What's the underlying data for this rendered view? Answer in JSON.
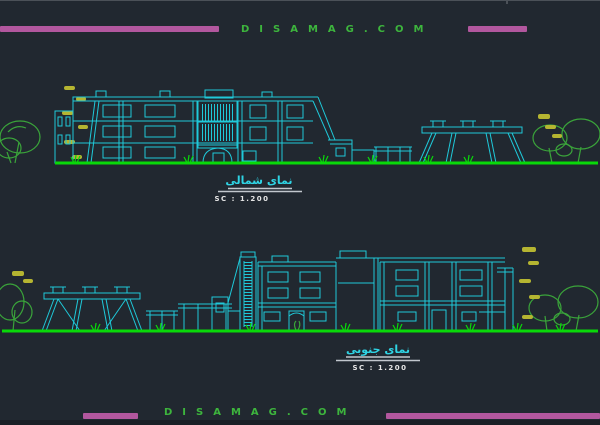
{
  "watermark": {
    "text": "DISAMAG.COM"
  },
  "colors": {
    "background": "#212830",
    "line_cyan": "#1fc9d9",
    "ground_green": "#09d909",
    "tree_green": "#3aa43a",
    "accent_yellow": "#b5b531",
    "bar_magenta": "#b2579e",
    "watermark_green": "#3db53d",
    "title_cyan": "#2fd4e4",
    "scale_text": "#e6e6e6",
    "underline_gray": "#c2c7cd"
  },
  "elevations": [
    {
      "id": "north",
      "title": "نمای شمالی",
      "scale": "SC : 1.200"
    },
    {
      "id": "south",
      "title": "نمای جنوبی",
      "scale": "SC : 1.200"
    }
  ]
}
